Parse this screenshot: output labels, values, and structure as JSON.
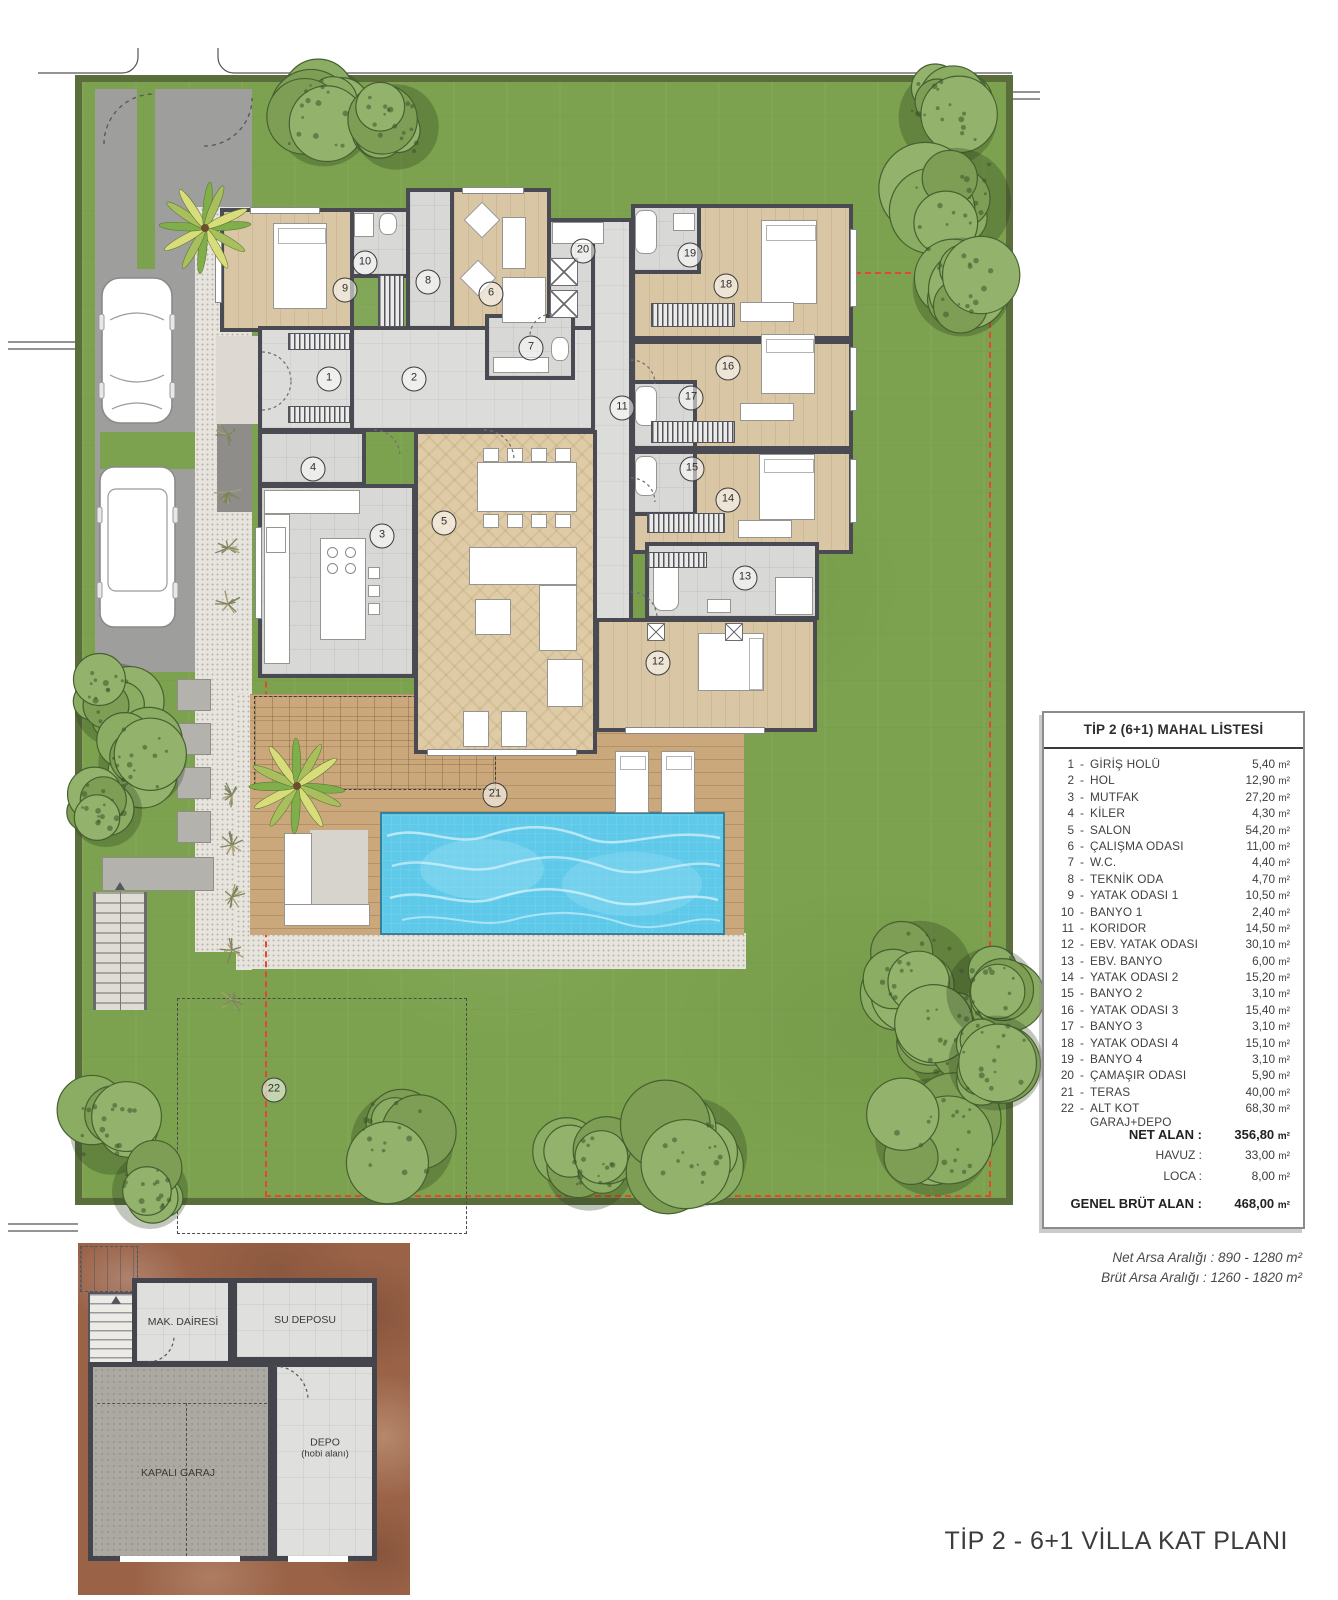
{
  "page": {
    "title": "TİP 2 - 6+1 VİLLA KAT PLANI"
  },
  "legend": {
    "header": "TİP 2 (6+1) MAHAL LİSTESİ",
    "dash": "-",
    "unit": "m²",
    "rows": [
      {
        "no": "1",
        "name": "GİRİŞ HOLÜ",
        "area": "5,40"
      },
      {
        "no": "2",
        "name": "HOL",
        "area": "12,90"
      },
      {
        "no": "3",
        "name": "MUTFAK",
        "area": "27,20"
      },
      {
        "no": "4",
        "name": "KİLER",
        "area": "4,30"
      },
      {
        "no": "5",
        "name": "SALON",
        "area": "54,20"
      },
      {
        "no": "6",
        "name": "ÇALIŞMA ODASI",
        "area": "11,00"
      },
      {
        "no": "7",
        "name": "W.C.",
        "area": "4,40"
      },
      {
        "no": "8",
        "name": "TEKNİK ODA",
        "area": "4,70"
      },
      {
        "no": "9",
        "name": "YATAK ODASI 1",
        "area": "10,50"
      },
      {
        "no": "10",
        "name": "BANYO 1",
        "area": "2,40"
      },
      {
        "no": "11",
        "name": "KORIDOR",
        "area": "14,50"
      },
      {
        "no": "12",
        "name": "EBV. YATAK ODASI",
        "area": "30,10"
      },
      {
        "no": "13",
        "name": "EBV. BANYO",
        "area": "6,00"
      },
      {
        "no": "14",
        "name": "YATAK ODASI 2",
        "area": "15,20"
      },
      {
        "no": "15",
        "name": "BANYO 2",
        "area": "3,10"
      },
      {
        "no": "16",
        "name": "YATAK ODASI 3",
        "area": "15,40"
      },
      {
        "no": "17",
        "name": "BANYO 3",
        "area": "3,10"
      },
      {
        "no": "18",
        "name": "YATAK ODASI 4",
        "area": "15,10"
      },
      {
        "no": "19",
        "name": "BANYO 4",
        "area": "3,10"
      },
      {
        "no": "20",
        "name": "ÇAMAŞIR ODASI",
        "area": "5,90"
      },
      {
        "no": "21",
        "name": "TERAS",
        "area": "40,00"
      },
      {
        "no": "22",
        "name": "ALT KOT GARAJ+DEPO",
        "area": "68,30"
      }
    ],
    "summary": [
      {
        "label": "NET ALAN :",
        "value": "356,80",
        "bold": true
      },
      {
        "label": "HAVUZ :",
        "value": "33,00",
        "bold": false
      },
      {
        "label": "LOCA :",
        "value": "8,00",
        "bold": false
      },
      {
        "label": "GENEL BRÜT ALAN :",
        "value": "468,00",
        "bold": true
      }
    ]
  },
  "site_notes": {
    "line1": "Net Arsa Aralığı :  890  -  1280 m²",
    "line2": "Brüt Arsa Aralığı :  1260  -  1820 m²"
  },
  "basement": {
    "mak": "MAK. DAİRESİ",
    "su": "SU DEPOSU",
    "garaj": "KAPALI GARAJ",
    "depo": "DEPO",
    "depo_sub": "(hobi alanı)"
  },
  "plan": {
    "badges": [
      "1",
      "2",
      "3",
      "4",
      "5",
      "6",
      "7",
      "8",
      "9",
      "10",
      "11",
      "12",
      "13",
      "14",
      "15",
      "16",
      "17",
      "18",
      "19",
      "20",
      "21",
      "22"
    ]
  },
  "colors": {
    "grass": "#7CA24F",
    "hedge": "#5B6C3D",
    "wall": "#4A4A52",
    "pool": "#5FC9EA",
    "deck": "#CBA87B",
    "setback_line": "#E8442E",
    "earth": "#9A6348"
  }
}
